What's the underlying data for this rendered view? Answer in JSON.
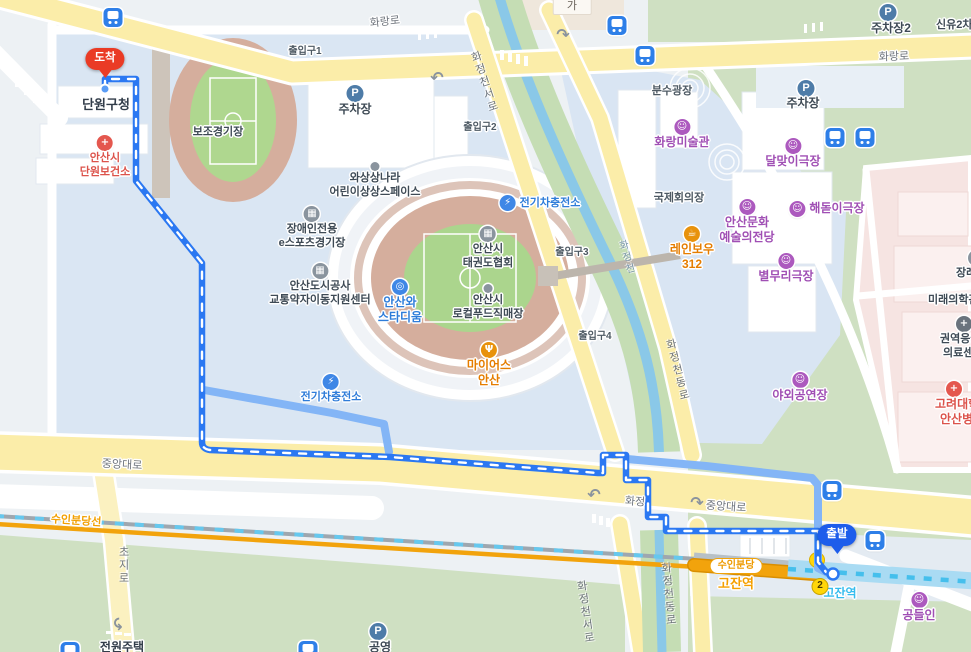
{
  "map": {
    "markers": {
      "arrival": "도착",
      "departure": "출발"
    },
    "roads": {
      "hwarang_ro": "화랑로",
      "hwarang_ro_2": "화랑로",
      "jungang_daero_left": "중앙대로",
      "jungang_daero_right": "중앙대로",
      "hwajeong": "화정",
      "choji_ro": "초지로",
      "hwajeongcheonseo_ro_top": "화정천서로",
      "hwajeongcheonseo_ro_bottom": "화정천서로",
      "hwajeongcheondong_ro_mid": "화정천동로",
      "hwajeongcheondong_ro_bottom": "화정천동로",
      "stream": "화정천"
    },
    "transit": {
      "line_label": "수인분당선",
      "station_badge": "수인분당",
      "station_suin": "고잔역",
      "station_line4": "고잔역",
      "exit_2": "2",
      "parking_p": "P"
    },
    "entrances": {
      "e1": "출입구1",
      "e2": "출입구2",
      "e3": "출입구3",
      "e4": "출입구4"
    },
    "pois": {
      "danwon_office": "단원구청",
      "health_center": {
        "l1": "안산시",
        "l2": "단원보건소"
      },
      "bojo_stadium": "보조경기장",
      "parking_top": "주차장",
      "parking_right": "주차장",
      "parking2": "주차장2",
      "parking_public": "공영",
      "shinyu2cha": "신유2차",
      "ga_label": "가",
      "ga_upper_marks": "▪▪▪▪",
      "fountain_plaza": "분수광장",
      "hwarang_museum": "화랑미술관",
      "dalmaji_theater": "달맞이극장",
      "intl_conference": "국제회의장",
      "haedoji_theater": "해돋이극장",
      "arts_center": {
        "l1": "안산문화",
        "l2": "예술의전당"
      },
      "rainbow": {
        "l1": "레인보우",
        "l2": "312"
      },
      "byulmuri_theater": "별무리극장",
      "funeral": "장례식장",
      "future_med": "미래의학관",
      "emergency": {
        "l1": "권역응급",
        "l2": "의료센터"
      },
      "korea_univ": {
        "l1": "고려대학교",
        "l2": "안산병원"
      },
      "outdoor_stage": "야외공연장",
      "imagination": {
        "l1": "와상상나라",
        "l2": "어린이상상스페이스"
      },
      "ev_charge_1": "전기차충전소",
      "ev_charge_2": "전기차충전소",
      "esports": {
        "l1": "장애인전용",
        "l2": "e스포츠경기장"
      },
      "taekwondo": {
        "l1": "안산시",
        "l2": "태권도협회"
      },
      "mobility_center": {
        "l1": "안산도시공사",
        "l2": "교통약자이동지원센터"
      },
      "wa_stadium": {
        "l1": "안산와",
        "l2": "스타디움"
      },
      "localfood": {
        "l1": "안산시",
        "l2": "로컬푸드직매장"
      },
      "myers": {
        "l1": "마이어스",
        "l2": "안산"
      },
      "gongdeulin": "공들인",
      "jeonwon_house": "전원주택"
    },
    "colors": {
      "route_main": "#2B78F2",
      "route_alt": "#83B5F6",
      "line_suinbundang": "#F2A30C",
      "line_4": "#45BFEC",
      "marker_arrival": "#EA3B25",
      "marker_departure": "#1D5DEB",
      "road_major": "#FBEDA9",
      "park_green": "#CFE0C2",
      "hospital_pink": "#F6E4E2"
    }
  }
}
